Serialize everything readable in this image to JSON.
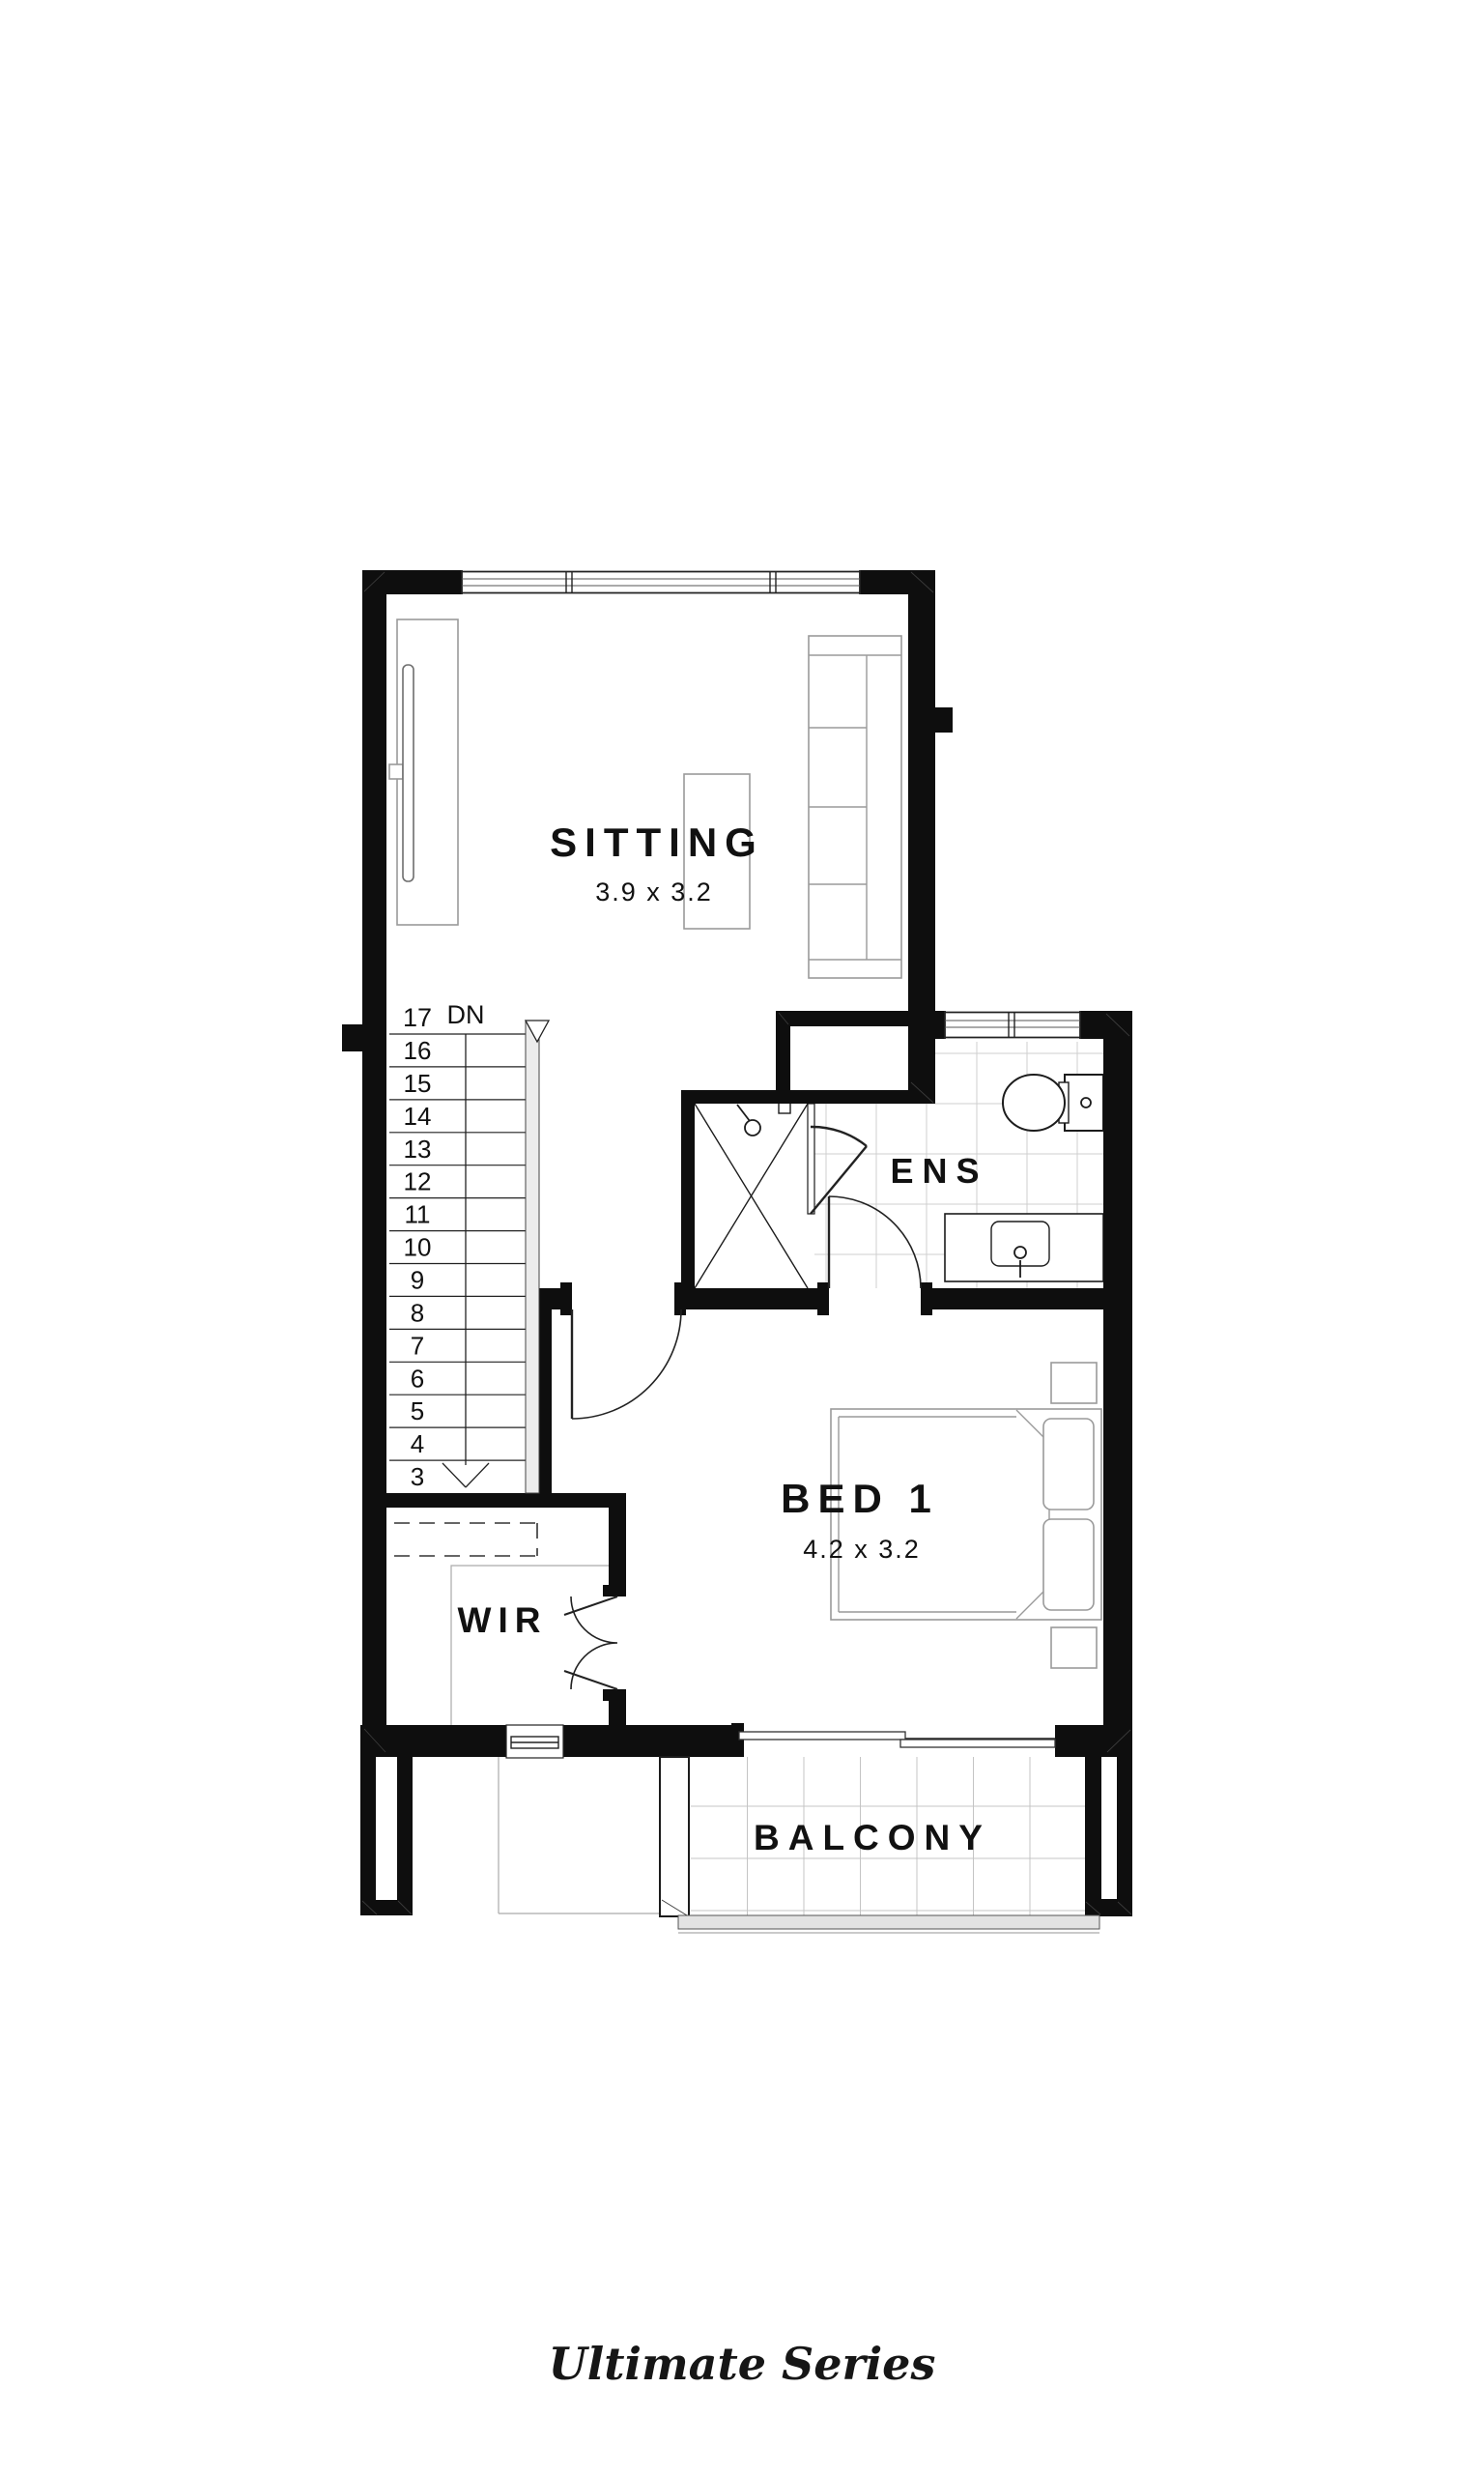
{
  "series_label": "Ultimate Series",
  "rooms": {
    "sitting": {
      "label": "SITTING",
      "dimensions": "3.9 x 3.2"
    },
    "ens": {
      "label": "ENS"
    },
    "bed1": {
      "label": "BED 1",
      "dimensions": "4.2 x 3.2"
    },
    "wir": {
      "label": "WIR"
    },
    "balcony": {
      "label": "BALCONY"
    }
  },
  "stairs": {
    "top_tread_label": "17",
    "direction_label": "DN",
    "treads": [
      "16",
      "15",
      "14",
      "13",
      "12",
      "11",
      "10",
      "9",
      "8",
      "7",
      "6",
      "5",
      "4",
      "3"
    ],
    "tread_count": 17
  },
  "fixtures": [
    "tv-unit",
    "coffee-table",
    "sofa",
    "staircase",
    "handrail",
    "shower",
    "shower-head",
    "shower-screen",
    "pivot-door",
    "toilet",
    "vanity",
    "basin",
    "bed",
    "pillows",
    "bedside-tables",
    "wardrobe-shelving",
    "hinged-doors",
    "sliding-door",
    "windows",
    "balustrade"
  ],
  "colors": {
    "wall": "#0e0e0e",
    "tile_line": "#cfcfcf",
    "fixture_line": "#1c1c1c",
    "furniture_line": "#9a9a9a",
    "text": "#111111",
    "balustrade_fill": "#e3e3e3",
    "background": "#ffffff"
  }
}
